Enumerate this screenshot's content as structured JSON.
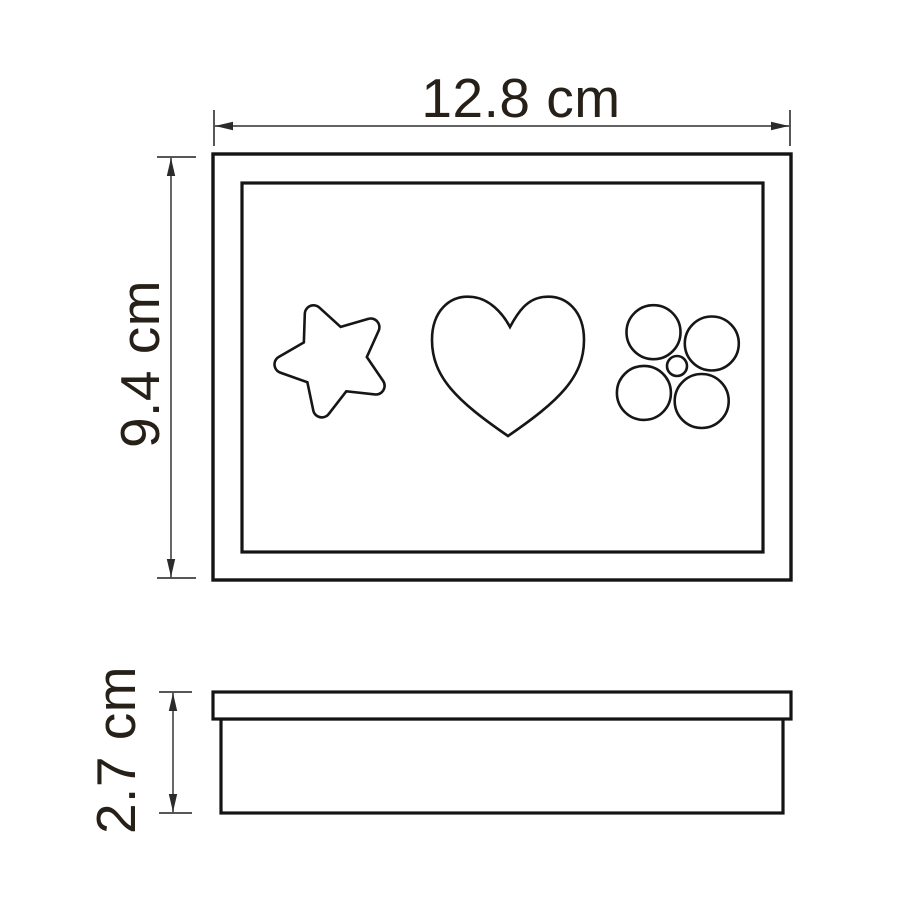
{
  "canvas": {
    "width": 900,
    "height": 900,
    "background": "#ffffff"
  },
  "colors": {
    "outline": "#141414",
    "shape_outline": "#161616",
    "dimension_line": "#4c4c4c",
    "arrow": "#2b2b2b",
    "text": "#262019"
  },
  "dimensions": {
    "width_label": "12.8 cm",
    "height_label": "9.4 cm",
    "depth_label": "2.7 cm"
  },
  "icons": [
    "star-icon",
    "heart-icon",
    "flower-icon"
  ]
}
